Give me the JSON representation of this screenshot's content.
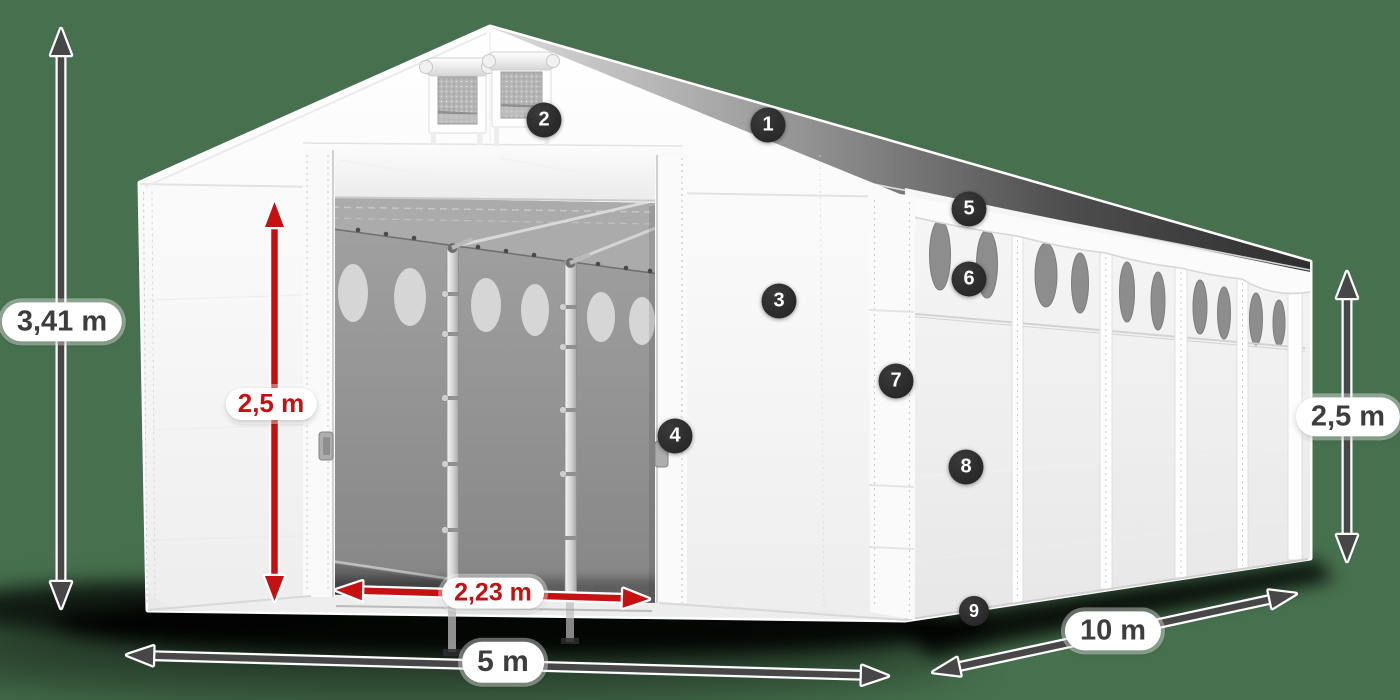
{
  "scene": {
    "description": "3D product illustration of a white storage tent (5 x 10 m) with dimension arrows and numbered feature markers",
    "background_color": "#47714e",
    "tent_color": "#f6f6f6",
    "red_accent": "#c51111",
    "arrow_color": "#474747",
    "marker_color": "#262626"
  },
  "dimensions": {
    "total_height": {
      "label": "3,41 m",
      "accent": "dark"
    },
    "entrance_height": {
      "label": "2,5 m",
      "accent": "red"
    },
    "entrance_width": {
      "label": "2,23 m",
      "accent": "red"
    },
    "width": {
      "label": "5 m",
      "accent": "dark"
    },
    "length": {
      "label": "10 m",
      "accent": "dark"
    },
    "side_height": {
      "label": "2,5 m",
      "accent": "dark"
    }
  },
  "markers": [
    {
      "label": "1"
    },
    {
      "label": "2"
    },
    {
      "label": "3"
    },
    {
      "label": "4"
    },
    {
      "label": "5"
    },
    {
      "label": "6"
    },
    {
      "label": "7"
    },
    {
      "label": "8"
    },
    {
      "label": "9"
    }
  ]
}
